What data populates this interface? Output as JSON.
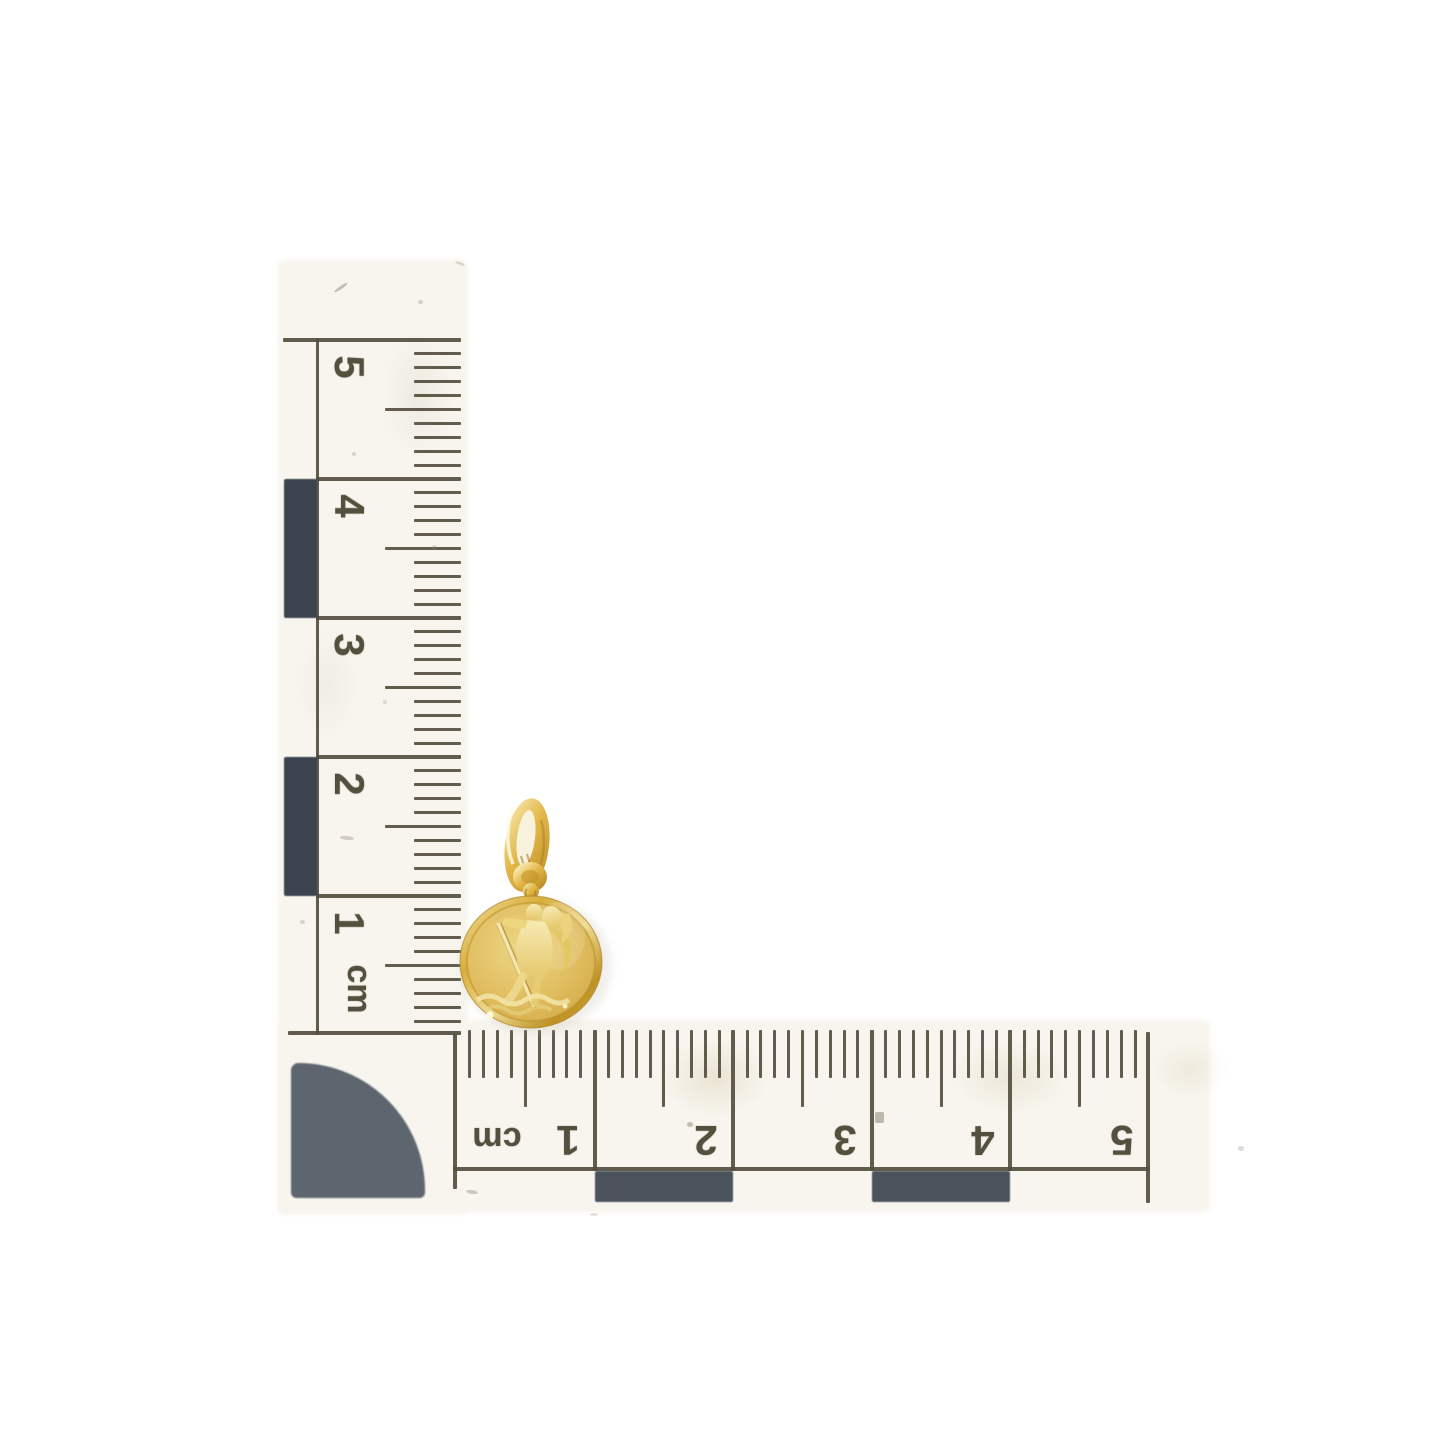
{
  "scene": {
    "description": "Yellow gold round St. Christopher medal pendant photographed on a white background with an L-shaped centimetre photographic scale",
    "background_color": "#ffffff"
  },
  "scale": {
    "unit": "cm",
    "vertical_arm": {
      "tick_labels": [
        "5",
        "4",
        "3",
        "2",
        "1"
      ],
      "unit_label": "cm"
    },
    "horizontal_arm": {
      "tick_labels": [
        "1",
        "2",
        "3",
        "4",
        "5"
      ],
      "unit_label": "cm"
    }
  },
  "pendant": {
    "name": "st-christopher-medal-pendant",
    "material": "gold"
  },
  "colors": {
    "print": "#55503e",
    "paper": "#f7f5ee",
    "block_vertical": "#3a434e",
    "block_horizontal": "#4b535d",
    "block_corner": "#5d656e",
    "gold_light": "#f7e9b4",
    "gold_mid": "#e0b74f",
    "gold_deep": "#bb8d26"
  }
}
